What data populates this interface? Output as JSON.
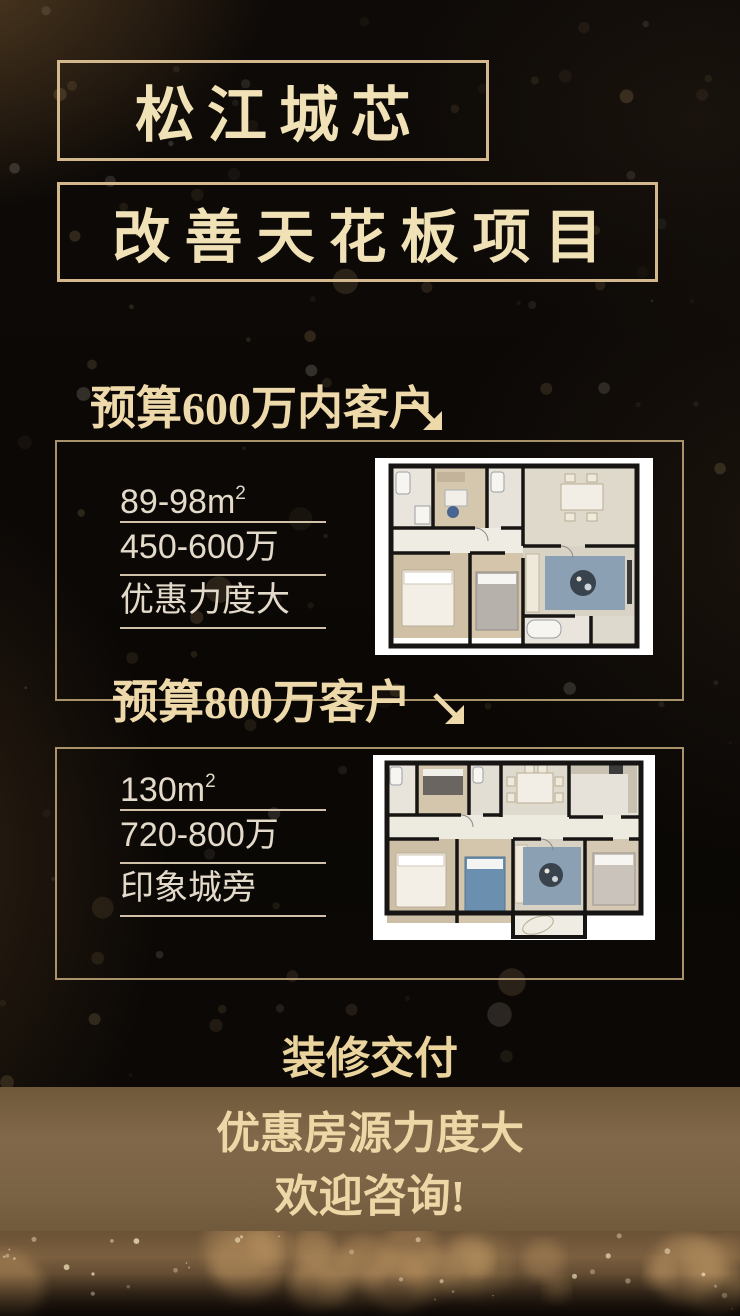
{
  "header": {
    "title_line1": "松江城芯",
    "title_line2": "改善天花板项目"
  },
  "sections": [
    {
      "heading": "预算600万内客户",
      "specs": [
        {
          "text": "89-98m",
          "sup": "2"
        },
        {
          "text": "450-600万",
          "sup": ""
        },
        {
          "text": "优惠力度大",
          "sup": ""
        }
      ]
    },
    {
      "heading": "预算800万客户",
      "specs": [
        {
          "text": "130m",
          "sup": "2"
        },
        {
          "text": "720-800万",
          "sup": ""
        },
        {
          "text": "印象城旁",
          "sup": ""
        }
      ]
    }
  ],
  "footer": {
    "line1": "装修交付",
    "line2": "优惠房源力度大",
    "line3": "欢迎咨询!"
  },
  "colors": {
    "accent_gold": "#eed9ab",
    "title_text": "#f1e1b6",
    "border_gold": "#d2b88c",
    "card_border": "#ba a175",
    "spec_text": "#e4daca",
    "band_brown": "#7d6243",
    "floor_plan_bg": "#ffffff"
  }
}
